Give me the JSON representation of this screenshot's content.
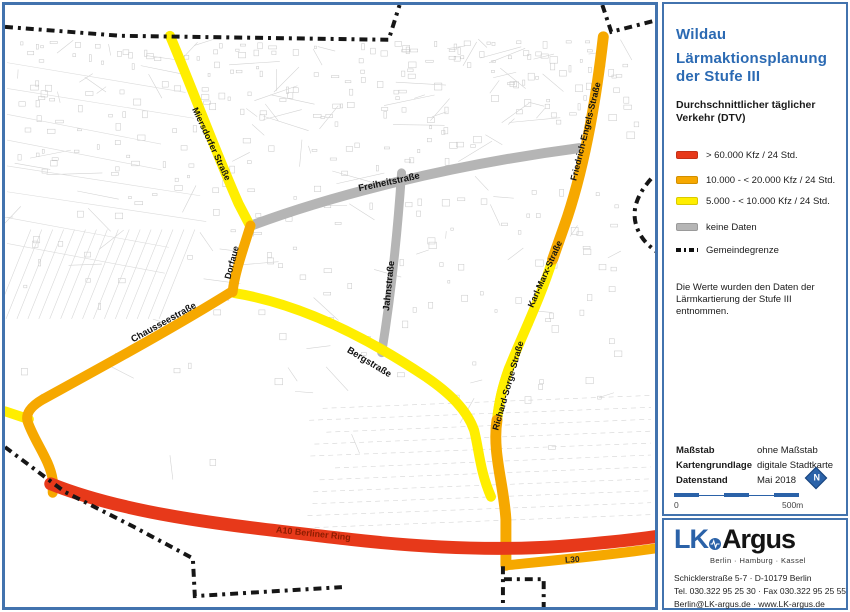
{
  "panel": {
    "title1": "Wildau",
    "title2": "Lärmaktionsplanung",
    "title3": "der Stufe III",
    "heading": "Durchschnittlicher täglicher Verkehr (DTV)",
    "items": [
      {
        "color": "#e7391a",
        "label": "> 60.000 Kfz / 24 Std."
      },
      {
        "color": "#f6a800",
        "label": "10.000 - < 20.000 Kfz / 24 Std."
      },
      {
        "color": "#ffee00",
        "label": "5.000 - < 10.000 Kfz / 24 Std."
      },
      {
        "color": "#b5b5b5",
        "label": "keine Daten"
      },
      {
        "type": "boundary",
        "label": "Gemeindegrenze"
      }
    ],
    "note": "Die Werte wurden den Daten der Lärmkartierung der Stufe III entnommen.",
    "meta": [
      {
        "label": "Maßstab",
        "value": "ohne Maßstab"
      },
      {
        "label": "Kartengrundlage",
        "value": "digitale Stadtkarte"
      },
      {
        "label": "Datenstand",
        "value": "Mai 2018"
      }
    ],
    "scalebar": {
      "left": "0",
      "right": "500m"
    },
    "north": "N"
  },
  "logo": {
    "lk": "LK",
    "argus": "Argus",
    "cities": "Berlin · Hamburg · Kassel",
    "address1": "Schicklerstraße 5-7  ·  D-10179 Berlin",
    "address2": "Tel. 030.322 95 25 30  ·  Fax 030.322 95 25 55",
    "address3": "Berlin@LK-argus.de  ·  www.LK-argus.de"
  },
  "map": {
    "colors": {
      "red": "#e7391a",
      "orange": "#f6a800",
      "yellow": "#ffee00",
      "gray": "#b5b5b5"
    },
    "boundary_color": "#161616",
    "roads": [
      {
        "name": "Freiheitstraße",
        "color": "gray",
        "width": 10,
        "z": 1,
        "path": "M250,224 C330,194 450,163 580,146",
        "label": {
          "text": "Freiheitstraße",
          "x": 389,
          "y": 183,
          "rotate": -12,
          "size": 9.5
        }
      },
      {
        "name": "Jahnstraße",
        "color": "gray",
        "width": 9,
        "z": 1,
        "path": "M401,171 C397,230 391,290 381,352",
        "label": {
          "text": "Jahnstraße",
          "x": 391,
          "y": 285,
          "rotate": -84,
          "size": 9.5
        }
      },
      {
        "name": "Miersdorfer Straße",
        "color": "yellow",
        "width": 10,
        "z": 2,
        "path": "M168,33 C190,85 214,150 237,202 L249,225",
        "label": {
          "text": "Miersdorfer Straße",
          "x": 207,
          "y": 143,
          "rotate": 65,
          "size": 9
        }
      },
      {
        "name": "Karl-Marx-Straße",
        "color": "yellow",
        "width": 10,
        "z": 2,
        "path": "M553,258 C541,297 522,335 509,368 C503,385 499,400 497,422",
        "label": {
          "text": "Karl-Marx-Straße",
          "x": 548,
          "y": 274,
          "rotate": -66,
          "size": 9
        }
      },
      {
        "name": "Richard-Sorge-Straße",
        "color": "yellow",
        "width": 10,
        "z": 2,
        "path": "M509,368 C503,385 499,400 497,420",
        "label": {
          "text": "Richard-Sorge-Straße",
          "x": 511,
          "y": 386,
          "rotate": -74,
          "size": 9
        }
      },
      {
        "name": "Bergstraße",
        "color": "yellow",
        "width": 10,
        "z": 2,
        "path": "M233,292 C300,303 365,336 425,376 C450,393 467,410 474,430 C479,450 480,472 491,497",
        "label": {
          "text": "Bergstraße",
          "x": 367,
          "y": 364,
          "rotate": 31,
          "size": 9.5
        }
      },
      {
        "name": "yellow-west-stub",
        "color": "yellow",
        "width": 10,
        "z": 2,
        "path": "M2,411 L26,419"
      },
      {
        "name": "Friedrich-Engels-Straße",
        "color": "orange",
        "width": 11,
        "z": 3,
        "path": "M604,34 C597,95 586,160 568,215 L553,258",
        "label": {
          "text": "Friedrich-Engels-Straße",
          "x": 589,
          "y": 130,
          "rotate": -76,
          "size": 9
        }
      },
      {
        "name": "Dorfaue",
        "color": "orange",
        "width": 10,
        "z": 3,
        "path": "M249,224 C241,250 233,272 231,291",
        "label": {
          "text": "Dorfaue",
          "x": 233,
          "y": 262,
          "rotate": -75,
          "size": 9
        }
      },
      {
        "name": "Chausseestraße",
        "color": "orange",
        "width": 10,
        "z": 3,
        "path": "M231,290 C170,328 100,366 40,399 C28,406 22,414 25,422 C32,442 47,460 50,480 L50,493",
        "label": {
          "text": "Chausseestraße",
          "x": 163,
          "y": 324,
          "rotate": -29,
          "size": 9.5
        }
      },
      {
        "name": "Richard-Sorge-Straße-süd",
        "color": "orange",
        "width": 11,
        "z": 3,
        "path": "M497,420 C492,452 504,485 506,520 L506,566"
      },
      {
        "name": "L30",
        "color": "orange",
        "width": 10,
        "z": 3,
        "path": "M507,566 C545,562 600,557 657,549",
        "label": {
          "text": "L30",
          "x": 573,
          "y": 563,
          "rotate": -4,
          "size": 8.5,
          "color": "#222222"
        }
      },
      {
        "name": "A10 Berliner Ring",
        "color": "red",
        "width": 13,
        "z": 4,
        "path": "M48,484 C130,517 240,527 350,540 C430,549 500,551 560,547 C600,544 630,541 657,537",
        "label": {
          "text": "A10 Berliner Ring",
          "x": 312,
          "y": 537,
          "rotate": 6,
          "size": 9,
          "color": "#8c1c00"
        }
      }
    ],
    "boundary": [
      "M2,24 L118,33 L388,37 L399,2",
      "M603,2 L612,29 L655,18",
      "M652,177 C637,194 631,211 639,229 C644,240 651,245 657,250",
      "M2,447 L62,492 L131,527 L191,559 L193,597 L341,588",
      "M503,567 L503,610",
      "M504,580 L544,580 L544,610"
    ]
  }
}
